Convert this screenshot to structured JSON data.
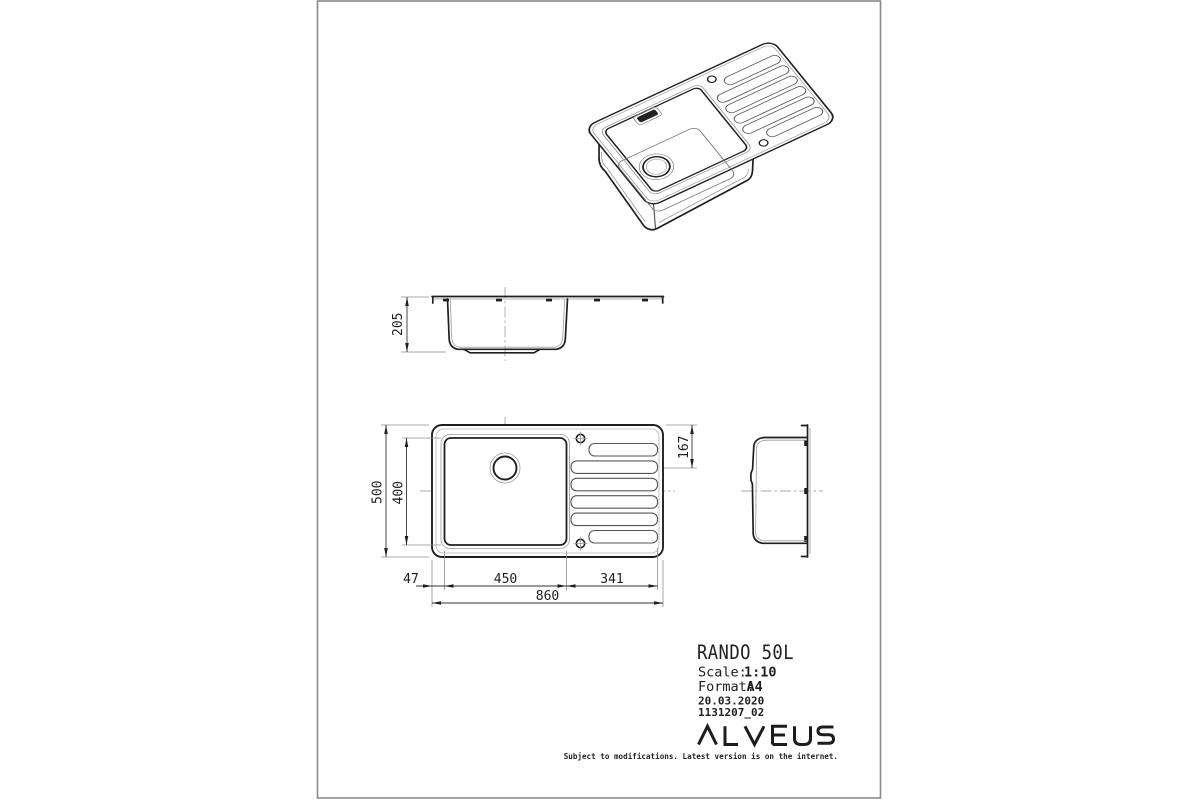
{
  "page": {
    "background": "#ffffff",
    "border_color": "#8a8a8a",
    "line_color": "#1f1f1f"
  },
  "title_block": {
    "product": "RANDO 50L",
    "scale_label": "Scale:",
    "scale_value": "1:10",
    "format_label": "Format:",
    "format_value": "A4",
    "date": "20.03.2020",
    "drawing_number": "1131207_02",
    "brand": "ALVEUS",
    "disclaimer": "Subject to modifications. Latest version is on the internet."
  },
  "dimensions_mm": {
    "overall_length": "860",
    "overall_width": "500",
    "bowl_length": "450",
    "bowl_width": "400",
    "bowl_depth": "205",
    "left_edge_offset": "47",
    "drainer_length": "341",
    "drain_center_from_edge": "167"
  }
}
